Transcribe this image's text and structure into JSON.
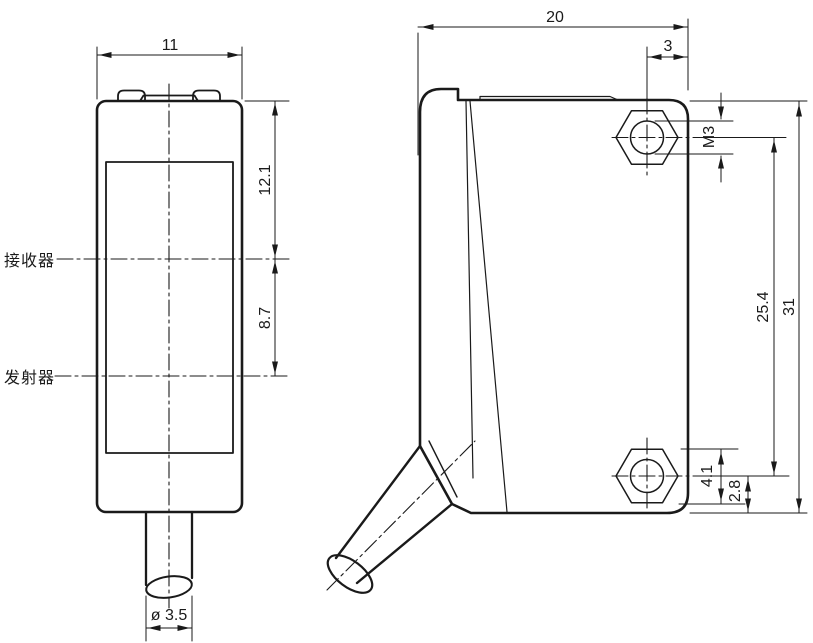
{
  "drawing": {
    "front_view": {
      "label_receiver": "接收器",
      "label_emitter": "发射器",
      "dim_width": "11",
      "dim_receiver_offset": "12.1",
      "dim_emitter_spacing": "8.7",
      "dim_cable_diameter": "ø 3.5"
    },
    "side_view": {
      "dim_depth": "20",
      "dim_hole_offset": "3",
      "dim_thread": "M3",
      "dim_hole_spacing": "25.4",
      "dim_height": "31",
      "dim_nut_width": "4.1",
      "dim_hole_to_bottom": "2.8"
    },
    "colors": {
      "line": "#1a1a1a",
      "background": "#ffffff"
    }
  }
}
